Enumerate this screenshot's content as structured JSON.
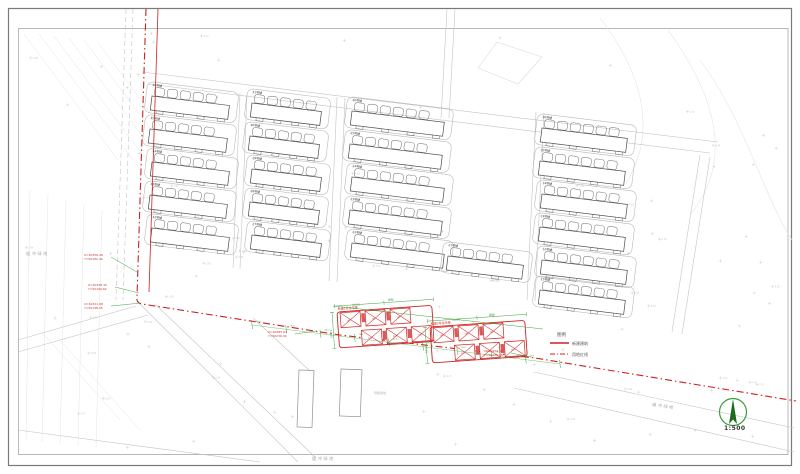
{
  "page": {
    "background": "#ffffff"
  },
  "colors": {
    "red": "#cc2222",
    "red_fill": "#d24040",
    "green": "#3fa23f",
    "green_dark": "#1c6b1c",
    "road": "#c4c4c4",
    "lot": "#b8b8b8",
    "building": "#4a4a4a",
    "faint": "#e4e4e4",
    "spot": "#d2d2d2",
    "spot_text": "#c9c9c9",
    "coord_text": "#cc3333",
    "structure": "#909090"
  },
  "scale": {
    "label": "1:500"
  },
  "legend": {
    "title": "图例",
    "entries": [
      {
        "label": "新建建筑",
        "style": "solid"
      },
      {
        "label": "用地红线",
        "style": "dashdot"
      }
    ]
  },
  "road_labels": [
    {
      "text": "缓冲绿地",
      "x": 26,
      "y": 255,
      "angle": 0
    },
    {
      "text": "缓冲绿地",
      "x": 652,
      "y": 406,
      "angle": 8
    },
    {
      "text": "缓冲绿地",
      "x": 312,
      "y": 460,
      "angle": 0
    }
  ],
  "green_labels": [
    {
      "text": "绿地",
      "x": 388,
      "y": 301,
      "angle": -4
    },
    {
      "text": "绿地",
      "x": 489,
      "y": 316,
      "angle": -4
    },
    {
      "text": "36.00",
      "x": 352,
      "y": 306,
      "angle": -4
    },
    {
      "text": "36.00",
      "x": 452,
      "y": 321,
      "angle": -4
    },
    {
      "text": "14.00",
      "x": 330,
      "y": 330,
      "angle": 86
    },
    {
      "text": "14.00",
      "x": 425,
      "y": 345,
      "angle": 86
    }
  ],
  "faint_labels": [
    {
      "text": "预留用地",
      "x": 374,
      "y": 394,
      "angle": 0
    }
  ],
  "coord_labels": [
    {
      "x": 84,
      "y": 256,
      "line1": "X=40356.26",
      "line2": "Y=50182.44",
      "lx": 137,
      "ly": 272
    },
    {
      "x": 88,
      "y": 286,
      "line1": "X=40338.15",
      "line2": "Y=50190.62",
      "lx": 139,
      "ly": 293
    },
    {
      "x": 84,
      "y": 305,
      "line1": "X=40321.08",
      "line2": "Y=50198.35",
      "lx": 141,
      "ly": 303
    },
    {
      "x": 268,
      "y": 333,
      "line1": "X=40285.63",
      "line2": "Y=50236.90",
      "lx": 316,
      "ly": 331
    },
    {
      "x": 484,
      "y": 352,
      "line1": "X=40252.34",
      "line2": "Y=50275.18",
      "lx": 531,
      "ly": 357
    }
  ],
  "buildings": [
    {
      "x": 152,
      "y": 96,
      "w": 78,
      "label": "36号楼"
    },
    {
      "x": 150,
      "y": 129,
      "w": 78,
      "label": "35号楼"
    },
    {
      "x": 152,
      "y": 162,
      "w": 78,
      "label": "34号楼"
    },
    {
      "x": 150,
      "y": 195,
      "w": 78,
      "label": "33号楼"
    },
    {
      "x": 152,
      "y": 228,
      "w": 78,
      "label": "32号楼"
    },
    {
      "x": 252,
      "y": 103,
      "w": 70,
      "label": "31号楼"
    },
    {
      "x": 250,
      "y": 136,
      "w": 70,
      "label": "30号楼"
    },
    {
      "x": 252,
      "y": 169,
      "w": 70,
      "label": "29号楼"
    },
    {
      "x": 250,
      "y": 202,
      "w": 70,
      "label": "28号楼"
    },
    {
      "x": 252,
      "y": 235,
      "w": 70,
      "label": "27号楼"
    },
    {
      "x": 352,
      "y": 111,
      "w": 93,
      "label": "26号楼"
    },
    {
      "x": 350,
      "y": 144,
      "w": 93,
      "label": "25号楼"
    },
    {
      "x": 352,
      "y": 177,
      "w": 93,
      "label": "24号楼"
    },
    {
      "x": 350,
      "y": 210,
      "w": 93,
      "label": "23号楼"
    },
    {
      "x": 352,
      "y": 243,
      "w": 93,
      "label": "22号楼"
    },
    {
      "x": 448,
      "y": 256,
      "w": 76,
      "label": "21号楼"
    },
    {
      "x": 542,
      "y": 128,
      "w": 86,
      "label": "16号楼"
    },
    {
      "x": 540,
      "y": 161,
      "w": 86,
      "label": "15号楼"
    },
    {
      "x": 542,
      "y": 194,
      "w": 86,
      "label": "14号楼"
    },
    {
      "x": 540,
      "y": 227,
      "w": 86,
      "label": "13号楼"
    },
    {
      "x": 542,
      "y": 260,
      "w": 86,
      "label": "12号楼"
    },
    {
      "x": 540,
      "y": 290,
      "w": 86,
      "label": "11号楼"
    }
  ],
  "new_groups": [
    {
      "x": 337,
      "y": 312,
      "angle": -4,
      "label": "新建1号住宅楼",
      "unit_text": "101"
    },
    {
      "x": 430,
      "y": 327,
      "angle": -4,
      "label": "新建2号住宅楼",
      "unit_text": "101"
    }
  ],
  "boundary": {
    "paths": [
      {
        "d": "M146,9 L137,297 Q136,303 142,304 L340,335 L535,358 L796,401",
        "dash": "7 3 1.5 3",
        "w": 1.1
      },
      {
        "d": "M158,9 L149,292",
        "dash": "",
        "w": 0.8
      }
    ]
  },
  "roads": [
    {
      "d": "M133,9 L123,300",
      "dash": "5 3"
    },
    {
      "d": "M126,9 L116,300",
      "dash": "5 3"
    },
    {
      "d": "M447,9 L441,118",
      "dash": ""
    },
    {
      "d": "M455,9 L449,118",
      "dash": ""
    },
    {
      "d": "M240,93 L233,268",
      "dash": ""
    },
    {
      "d": "M247,94 L240,269",
      "dash": ""
    },
    {
      "d": "M337,97 L329,281",
      "dash": ""
    },
    {
      "d": "M345,98 L337,282",
      "dash": ""
    },
    {
      "d": "M536,112 L527,300",
      "dash": ""
    },
    {
      "d": "M544,113 L535,301",
      "dash": ""
    },
    {
      "d": "M148,84 L710,153",
      "dash": ""
    },
    {
      "d": "M142,72 L718,142",
      "dash": ""
    },
    {
      "d": "M700,155 L672,332",
      "dash": ""
    },
    {
      "d": "M710,157 L682,334",
      "dash": ""
    },
    {
      "d": "M139,303 L298,462",
      "dash": ""
    },
    {
      "d": "M156,305 L316,458",
      "dash": ""
    },
    {
      "d": "M18,340 L136,306",
      "dash": ""
    },
    {
      "d": "M18,352 L148,315",
      "dash": ""
    },
    {
      "d": "M18,430 L260,462",
      "dash": ""
    },
    {
      "d": "M253,318 L310,371",
      "dash": ""
    },
    {
      "d": "M534,372 L794,428",
      "dash": ""
    },
    {
      "d": "M514,388 L794,452",
      "dash": ""
    }
  ],
  "terrain": {
    "seed": 7,
    "cross_count": 110,
    "diag_lines": [
      [
        24,
        34,
        118,
        160
      ],
      [
        39,
        34,
        133,
        160
      ],
      [
        54,
        36,
        148,
        162
      ],
      [
        69,
        38,
        163,
        164
      ],
      [
        84,
        40,
        178,
        166
      ],
      [
        99,
        44,
        193,
        170
      ],
      [
        30,
        190,
        26,
        440
      ],
      [
        48,
        195,
        42,
        442
      ],
      [
        66,
        200,
        60,
        444
      ],
      [
        84,
        205,
        78,
        446
      ],
      [
        102,
        210,
        96,
        448
      ],
      [
        40,
        330,
        120,
        420
      ],
      [
        60,
        340,
        140,
        430
      ]
    ],
    "curves": [
      "M600,18 C640,70 660,130 625,185",
      "M668,30 C715,95 735,160 690,215",
      "M700,60 C745,120 765,200 792,240"
    ],
    "pond": "M497,42 L542,57 L518,84 L478,68 Z"
  },
  "structures": [
    {
      "x": 299,
      "y": 370,
      "w": 15,
      "h": 57,
      "angle": 2
    },
    {
      "x": 341,
      "y": 369,
      "w": 21,
      "h": 47,
      "angle": 2
    }
  ],
  "green_line": {
    "d": "M333,306 L543,329"
  },
  "dim_chain": {
    "x1": 252,
    "y1": 325,
    "x2": 560,
    "y2": 364,
    "values": [
      "26.0",
      "30.5",
      "24.0",
      "28.6",
      "22.4",
      "30.0",
      "26.8",
      "24.2",
      "29.5"
    ]
  }
}
